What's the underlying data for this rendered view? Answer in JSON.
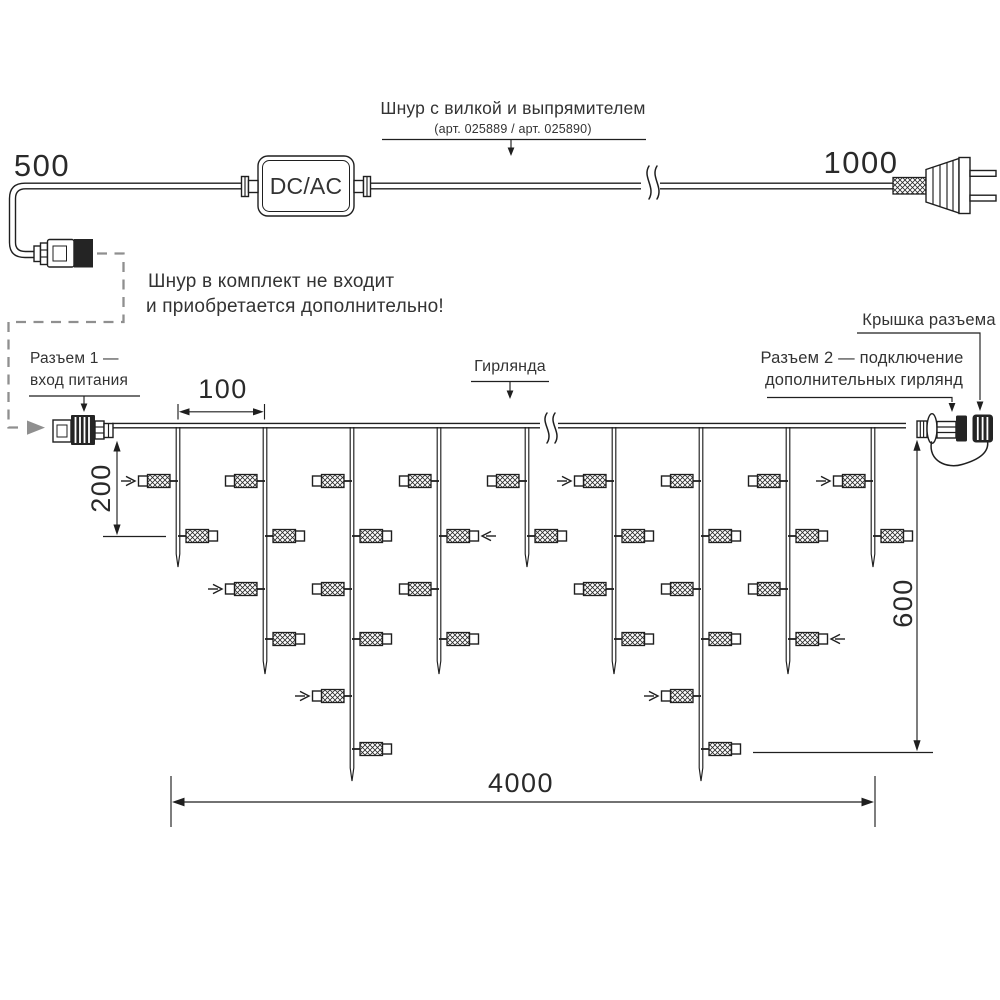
{
  "diagram": {
    "power_cord": {
      "left_length_label": "500",
      "right_length_label": "1000",
      "converter_label": "DC/AC",
      "cord_label_line1": "Шнур с вилкой и выпрямителем",
      "cord_label_line2": "(арт. 025889 / арт. 025890)",
      "note_line1": "Шнур в комплект не входит",
      "note_line2": "и приобретается дополнительно!"
    },
    "garland": {
      "label": "Гирлянда",
      "connector1_line1": "Разъем 1 —",
      "connector1_line2": "вход питания",
      "connector2_line1": "Разъем 2 — подключение",
      "connector2_line2": "дополнительных гирлянд",
      "cap_label": "Крышка разъема",
      "dimensions": {
        "drop_spacing": "100",
        "first_drop_length": "200",
        "max_drop_height": "600",
        "total_length": "4000"
      },
      "structure": {
        "wire_y": 427,
        "lamp_row_y": [
          481,
          536,
          589,
          639,
          696,
          749
        ],
        "tip_y": {
          "S": 567,
          "M": 674,
          "L": 781
        },
        "rows_per_size": {
          "S": 2,
          "M": 4,
          "L": 6
        },
        "drops": [
          {
            "x": 178,
            "size": "S",
            "chevron_rows": [
              1
            ]
          },
          {
            "x": 265,
            "size": "M",
            "chevron_rows": [
              3
            ]
          },
          {
            "x": 352,
            "size": "L",
            "chevron_rows": [
              5
            ]
          },
          {
            "x": 439,
            "size": "M",
            "chevron_rows": [
              2
            ]
          },
          {
            "x": 527,
            "size": "S",
            "chevron_rows": []
          },
          {
            "x": 614,
            "size": "M",
            "chevron_rows": [
              1
            ]
          },
          {
            "x": 701,
            "size": "L",
            "chevron_rows": [
              5
            ]
          },
          {
            "x": 788,
            "size": "M",
            "chevron_rows": [
              4
            ]
          },
          {
            "x": 873,
            "size": "S",
            "chevron_rows": [
              1
            ]
          }
        ]
      }
    },
    "colors": {
      "line": "#1f1f1f",
      "dashed_note_line": "#8f8f8f",
      "text": "#333333"
    }
  }
}
